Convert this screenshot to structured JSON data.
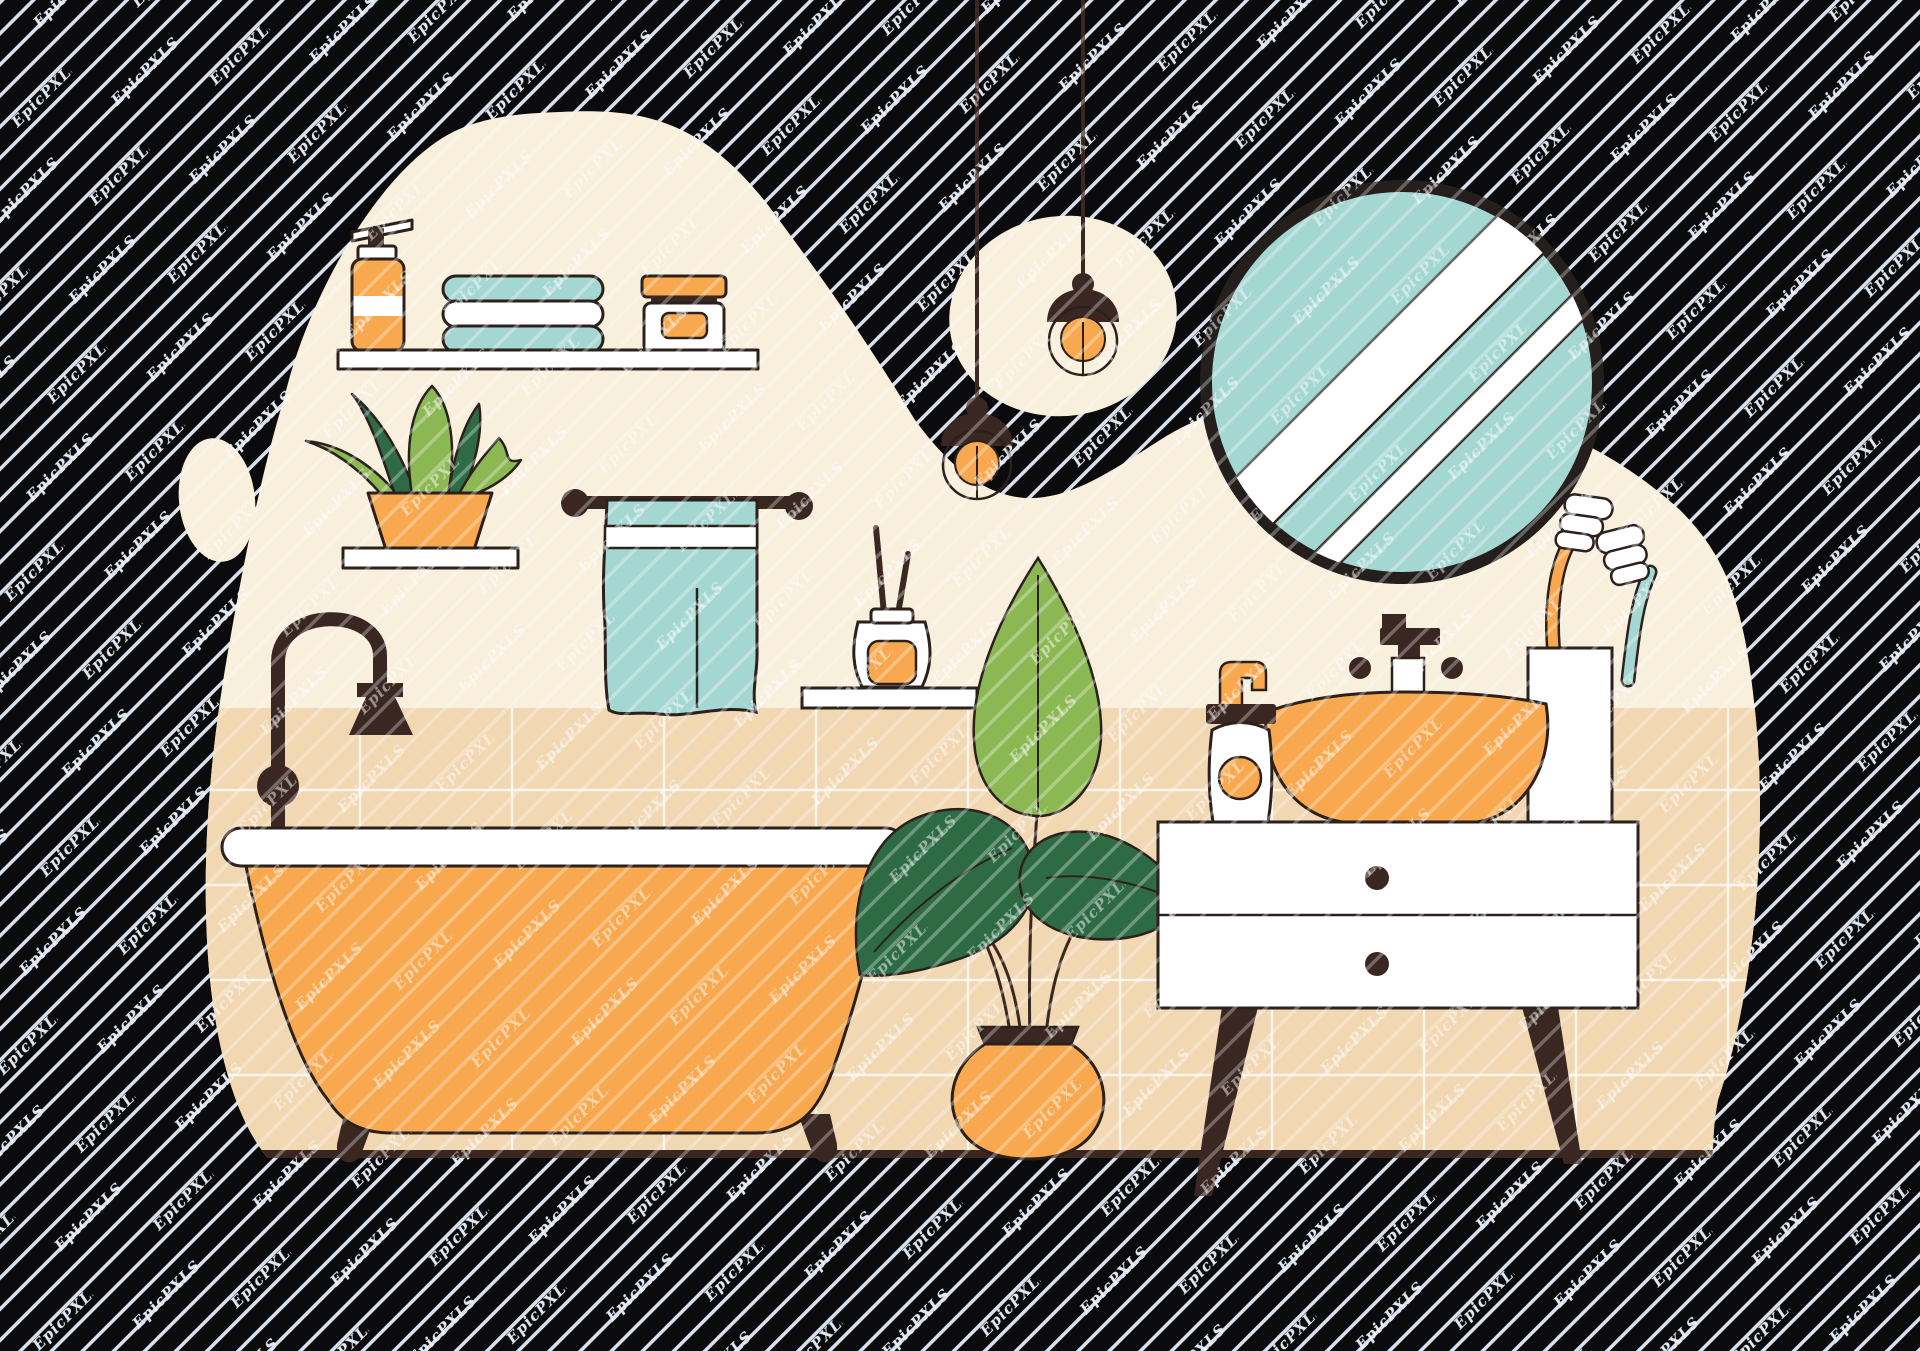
{
  "watermark": {
    "text": "EpicPXLS"
  },
  "palette": {
    "bg": "#0b0b0d",
    "stripe": "#c7d2e3",
    "cream": "#f8efdc",
    "tan": "#f1d7b2",
    "grout": "#ffffff",
    "orange": "#f8a84e",
    "teal": "#a5d7d2",
    "green_light": "#8cb854",
    "green_dark": "#2e6b45",
    "outline": "#2b201c",
    "brown": "#3a2721",
    "white": "#ffffff",
    "mirror_ring": "#241e1d"
  },
  "scene": {
    "title": "Flat bathroom interior illustration",
    "objects": [
      "wall shelf with soap bottle, folded towels and cream jar",
      "aloe plant on shelf",
      "towel on rail",
      "reed diffuser on shelf",
      "clawfoot bathtub with floor faucet",
      "potted plant",
      "vanity cabinet with vessel sink, soap pump and toothbrush cup",
      "round mirror",
      "two pendant lamps"
    ]
  }
}
